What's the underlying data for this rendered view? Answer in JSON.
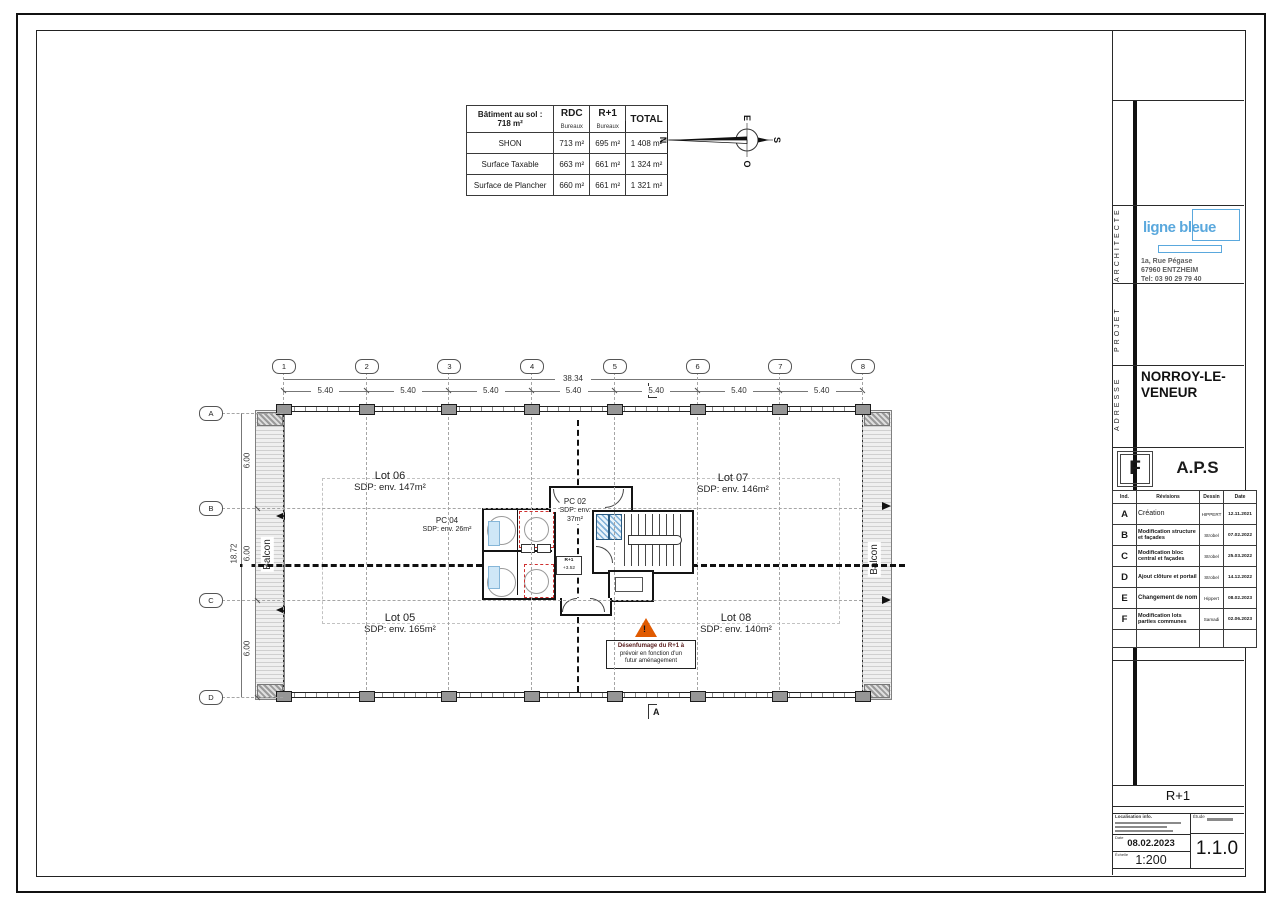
{
  "surface_table": {
    "corner_line1": "Bâtiment au sol :",
    "corner_line2": "718 m²",
    "col_rdc": "RDC",
    "col_rdc_sub": "Bureaux",
    "col_r1": "R+1",
    "col_r1_sub": "Bureaux",
    "col_total": "TOTAL",
    "rows": [
      {
        "label": "SHON",
        "rdc": "713 m²",
        "r1": "695 m²",
        "total": "1 408 m²"
      },
      {
        "label": "Surface Taxable",
        "rdc": "663 m²",
        "r1": "661 m²",
        "total": "1 324 m²"
      },
      {
        "label": "Surface de Plancher",
        "rdc": "660 m²",
        "r1": "661 m²",
        "total": "1 321 m²"
      }
    ]
  },
  "compass": {
    "n": "N",
    "e": "E",
    "s": "S",
    "o": "O"
  },
  "plan": {
    "grid_cols": [
      "1",
      "2",
      "3",
      "4",
      "5",
      "6",
      "7",
      "8"
    ],
    "grid_rows": [
      "A",
      "B",
      "C",
      "D"
    ],
    "dim_total_h": "38.34",
    "dim_seg_h": "5.40",
    "dim_total_v": "18.72",
    "dim_seg_v": "6.00",
    "section_marker": "A",
    "balcony_label": "Balcon",
    "lots": {
      "lot06": {
        "name": "Lot 06",
        "sdp": "SDP: env. 147m²"
      },
      "lot07": {
        "name": "Lot 07",
        "sdp": "SDP: env. 146m²"
      },
      "lot05": {
        "name": "Lot 05",
        "sdp": "SDP: env. 165m²"
      },
      "lot08": {
        "name": "Lot 08",
        "sdp": "SDP: env. 140m²"
      },
      "pc04": {
        "name": "PC 04",
        "sdp": "SDP: env. 26m²"
      },
      "pc02": {
        "name": "PC 02",
        "sdp1": "SDP: env.",
        "sdp2": "37m²"
      }
    },
    "level_marker": {
      "line1": "R+1",
      "line2": "+3.52"
    },
    "warning": {
      "line1": "Désenfumage du R+1 à",
      "line2": "prévoir en fonction d'un",
      "line3": "futur aménagement"
    }
  },
  "titleblock": {
    "side_labels": {
      "architecte": "ARCHITECTE",
      "projet": "PROJET",
      "adresse": "ADRESSE"
    },
    "architect": {
      "logo": "ligne bleue",
      "address1": "1a, Rue Pégase",
      "address2": "67960 ENTZHEIM",
      "address3": "Tel: 03 90 29 79 40"
    },
    "project_name_line1": "NORROY-LE-",
    "project_name_line2": "VENEUR",
    "index_letter": "F",
    "phase": "A.P.S",
    "revisions": {
      "h_ind": "Ind.",
      "h_rev": "Révisions",
      "h_des": "Dessin",
      "h_date": "Date",
      "rows": [
        {
          "ind": "A",
          "rev": "Création",
          "des": "HIPPERT",
          "date": "12.11.2021"
        },
        {
          "ind": "B",
          "rev": "Modification structure et façades",
          "des": "Strobel",
          "date": "07.02.2022"
        },
        {
          "ind": "C",
          "rev": "Modification bloc central et façades",
          "des": "Strobel",
          "date": "25.03.2022"
        },
        {
          "ind": "D",
          "rev": "Ajout clôture et portail",
          "des": "Strobel",
          "date": "14.12.2022"
        },
        {
          "ind": "E",
          "rev": "Changement de nom",
          "des": "Hippert",
          "date": "08.02.2023"
        },
        {
          "ind": "F",
          "rev": "Modification lots parties communes",
          "des": "Samadi",
          "date": "02.06.2023"
        }
      ]
    },
    "drawing_title": "R+1",
    "info": {
      "loc_label": "Localisation info.",
      "date_label": "Date",
      "date": "08.02.2023",
      "scale_label": "Échelle",
      "scale": "1:200",
      "etude_label": "Étude",
      "number": "1.1.0"
    }
  },
  "colors": {
    "logo_blue": "#5aa8dd",
    "warning_orange": "#e05a00",
    "red_dashed": "#cf3030"
  }
}
